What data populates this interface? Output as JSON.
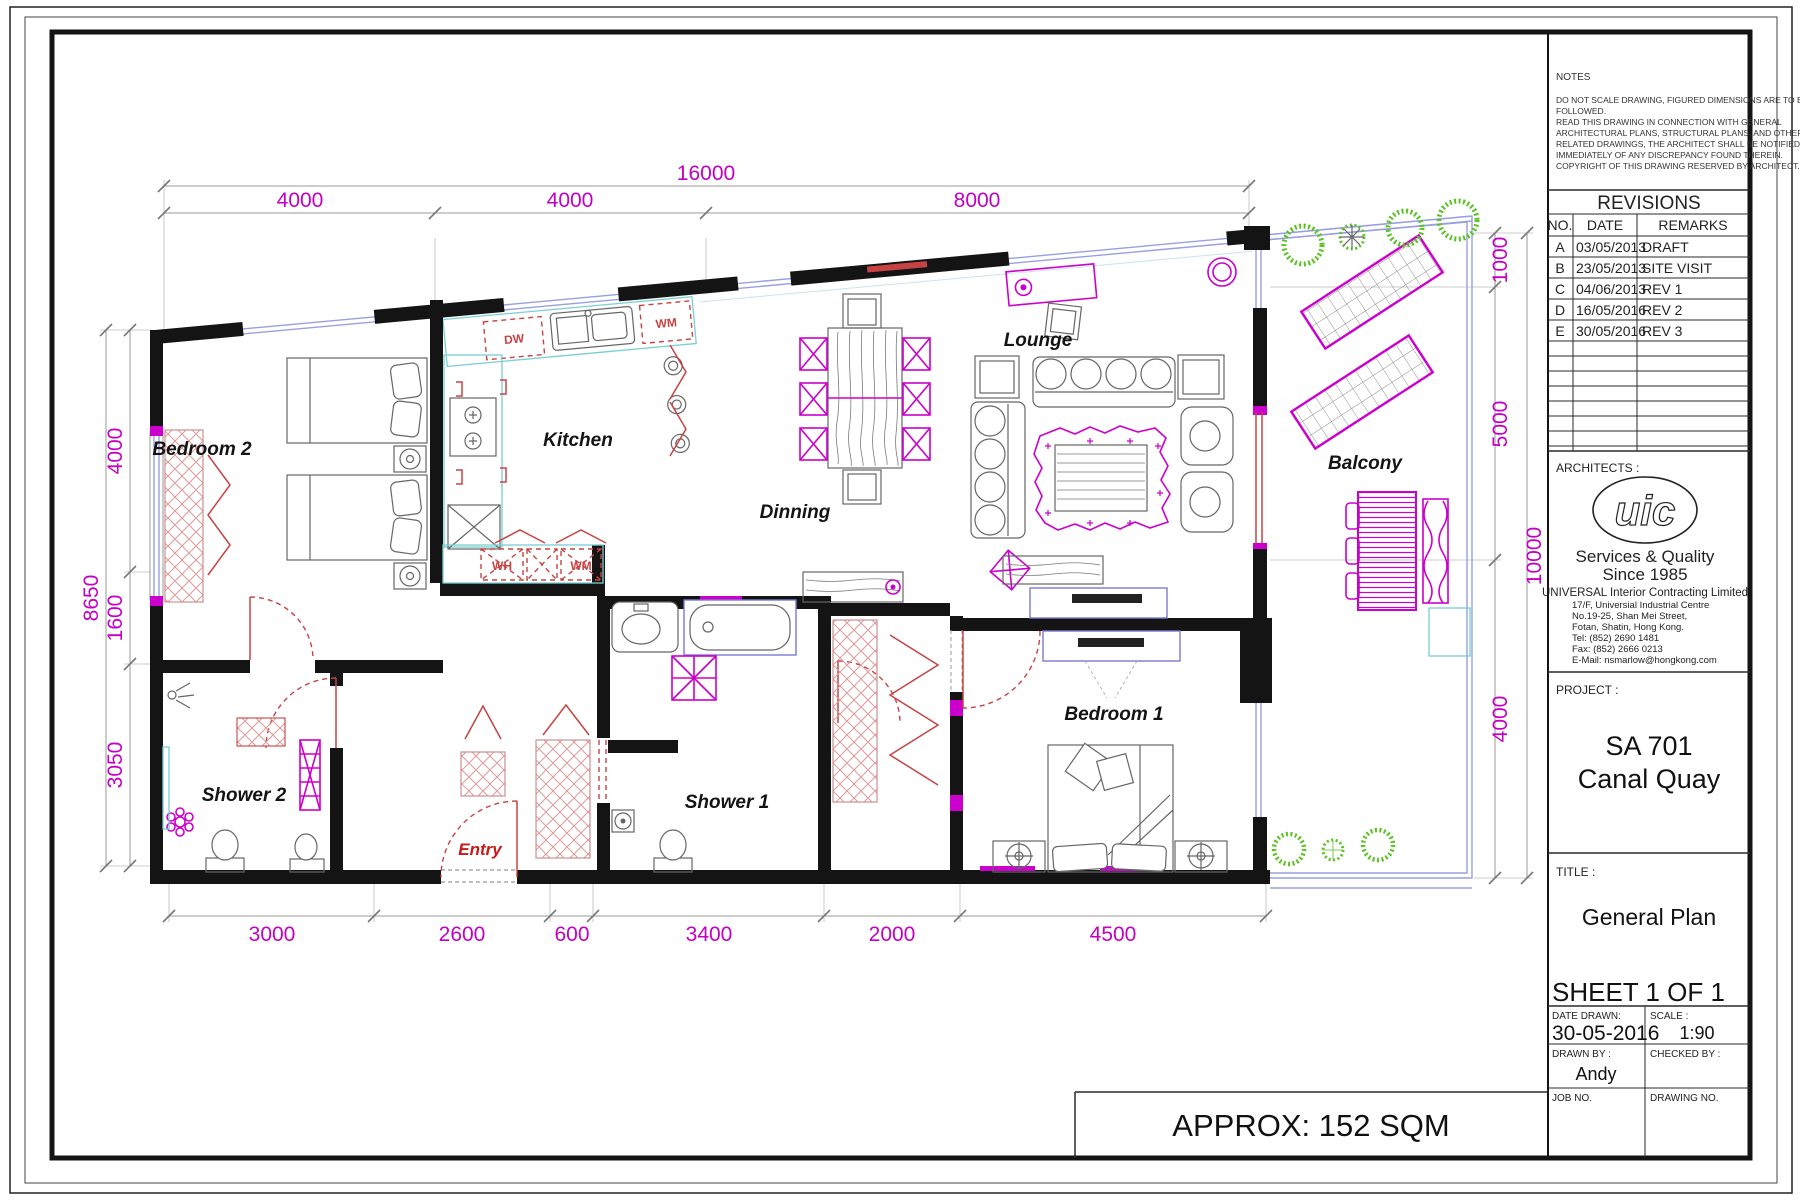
{
  "tb": {
    "notes": {
      "title": "NOTES",
      "lines": [
        "DO NOT SCALE DRAWING, FIGURED DIMENSIONS ARE TO BE",
        "FOLLOWED.",
        "READ THIS DRAWING IN CONNECTION WITH GENERAL",
        "ARCHITECTURAL PLANS, STRUCTURAL PLANS, AND OTHER",
        "RELATED DRAWINGS, THE ARCHITECT SHALL BE NOTIFIED",
        "IMMEDIATELY OF ANY DISCREPANCY FOUND THEREIN.",
        "COPYRIGHT OF THIS DRAWING RESERVED BY ARCHITECT."
      ]
    },
    "rev": {
      "title": "REVISIONS",
      "headers": [
        "NO.",
        "DATE",
        "REMARKS"
      ],
      "rows": [
        {
          "no": "A",
          "date": "03/05/2013",
          "remarks": "DRAFT"
        },
        {
          "no": "B",
          "date": "23/05/2013",
          "remarks": "SITE VISIT"
        },
        {
          "no": "C",
          "date": "04/06/2013",
          "remarks": "REV 1"
        },
        {
          "no": "D",
          "date": "16/05/2016",
          "remarks": "REV 2"
        },
        {
          "no": "E",
          "date": "30/05/2016",
          "remarks": "REV 3"
        }
      ]
    },
    "arch": {
      "label": "ARCHITECTS :",
      "logo": "uic",
      "tag1": "Services & Quality",
      "tag2": "Since 1985",
      "company": "UNIVERSAL Interior Contracting Limited",
      "addr": [
        "17/F, Universial Industrial Centre",
        "No.19-25, Shan Mei Street,",
        "Fotan, Shatin, Hong Kong.",
        "Tel: (852) 2690 1481",
        "Fax: (852) 2666 0213",
        "E-Mail: nsmarlow@hongkong.com"
      ]
    },
    "project": {
      "label": "PROJECT :",
      "line1": "SA 701",
      "line2": "Canal Quay"
    },
    "title": {
      "label": "TITLE :",
      "value": "General Plan"
    },
    "sheet": "SHEET 1 OF 1",
    "fields": {
      "date_label": "DATE DRAWN:",
      "date": "30-05-2016",
      "scale_label": "SCALE :",
      "scale": "1:90",
      "drawn_label": "DRAWN BY :",
      "drawn": "Andy",
      "checked_label": "CHECKED BY :",
      "job_label": "JOB NO.",
      "drawing_label": "DRAWING NO."
    },
    "approx": "APPROX: 152 SQM"
  },
  "plan": {
    "rooms": {
      "bedroom2": "Bedroom 2",
      "kitchen": "Kitchen",
      "dinning": "Dinning",
      "lounge": "Lounge",
      "balcony": "Balcony",
      "shower2": "Shower 2",
      "shower1": "Shower 1",
      "entry": "Entry",
      "bedroom1": "Bedroom 1"
    },
    "appliances": {
      "dw": "DW",
      "wm": "WM",
      "wh": "WH",
      "wm2": "WM"
    },
    "dims": {
      "top_total": "16000",
      "top": [
        "4000",
        "4000",
        "8000"
      ],
      "left_total": "8650",
      "left": [
        "4000",
        "1600",
        "3050"
      ],
      "right": [
        "1000",
        "5000",
        "4000"
      ],
      "right_total": "10000",
      "bottom": [
        "3000",
        "2600",
        "600",
        "3400",
        "2000",
        "4500"
      ]
    }
  },
  "colors": {
    "wall": "#141414",
    "dimension_text": "#c400c4",
    "magenta": "#cc00cc",
    "red": "#c74343",
    "glass": "#98a0e0",
    "counter": "#79cfd2",
    "plant": "#5bc224"
  }
}
